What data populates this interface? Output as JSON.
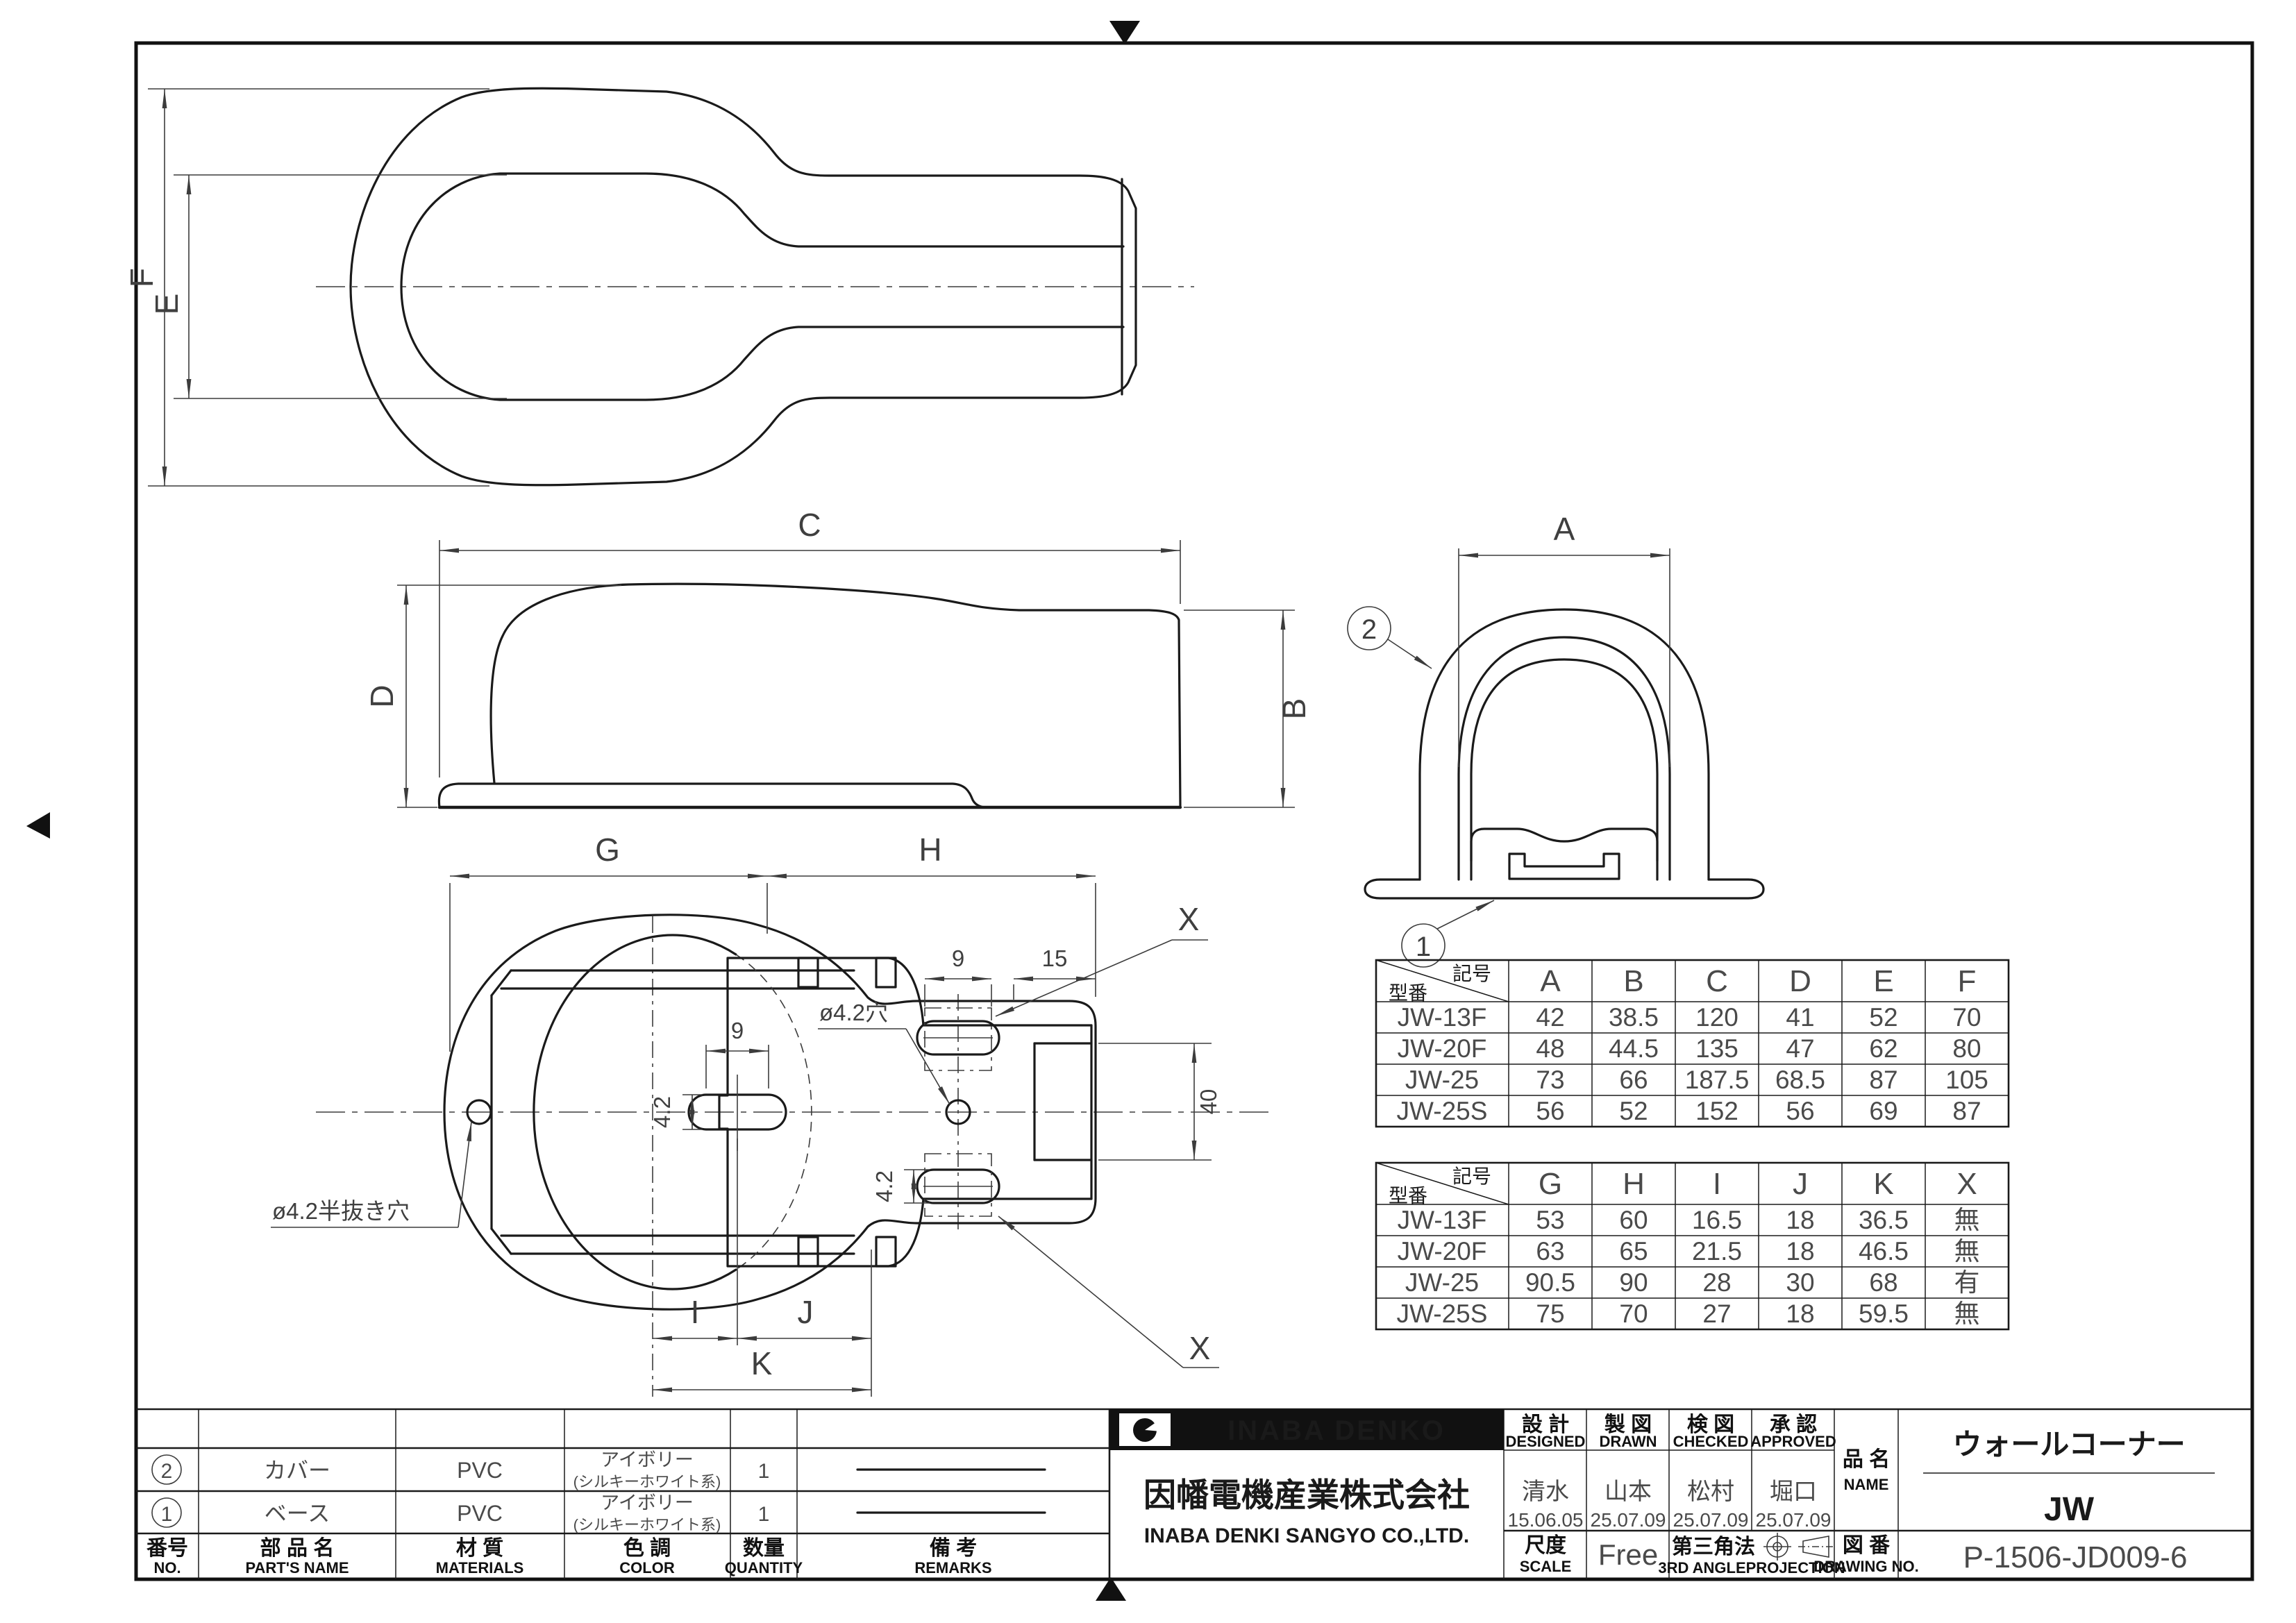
{
  "sheet": {
    "background": "#ffffff",
    "line_color": "#1a1a1a",
    "dim_color": "#4a4a4a"
  },
  "views": {
    "top_view": {
      "dim_E": "E",
      "dim_F": "F"
    },
    "side_view": {
      "dim_B": "B",
      "dim_C": "C",
      "dim_D": "D"
    },
    "front_view": {
      "dim_A": "A",
      "balloon_cover": "2",
      "balloon_base": "1"
    },
    "bottom_view": {
      "dim_G": "G",
      "dim_H": "H",
      "dim_I": "I",
      "dim_J": "J",
      "dim_K": "K",
      "dim_X_top": "X",
      "dim_X_bottom": "X",
      "dim_9_slot": "9",
      "dim_9_x": "9",
      "dim_15": "15",
      "dim_40": "40",
      "dim_42_a": "4.2",
      "dim_42_b": "4.2",
      "note_hole": "ø4.2穴",
      "note_half_hole": "ø4.2半抜き穴"
    }
  },
  "dim_table_1": {
    "corner_top": "記号",
    "corner_bottom": "型番",
    "columns": [
      "A",
      "B",
      "C",
      "D",
      "E",
      "F"
    ],
    "rows": [
      [
        "JW-13F",
        "42",
        "38.5",
        "120",
        "41",
        "52",
        "70"
      ],
      [
        "JW-20F",
        "48",
        "44.5",
        "135",
        "47",
        "62",
        "80"
      ],
      [
        "JW-25",
        "73",
        "66",
        "187.5",
        "68.5",
        "87",
        "105"
      ],
      [
        "JW-25S",
        "56",
        "52",
        "152",
        "56",
        "69",
        "87"
      ]
    ]
  },
  "dim_table_2": {
    "corner_top": "記号",
    "corner_bottom": "型番",
    "columns": [
      "G",
      "H",
      "I",
      "J",
      "K",
      "X"
    ],
    "rows": [
      [
        "JW-13F",
        "53",
        "60",
        "16.5",
        "18",
        "36.5",
        "無"
      ],
      [
        "JW-20F",
        "63",
        "65",
        "21.5",
        "18",
        "46.5",
        "無"
      ],
      [
        "JW-25",
        "90.5",
        "90",
        "28",
        "30",
        "68",
        "有"
      ],
      [
        "JW-25S",
        "75",
        "70",
        "27",
        "18",
        "59.5",
        "無"
      ]
    ]
  },
  "parts_table": {
    "headers": {
      "no_jp": "番号",
      "no_en": "NO.",
      "name_jp": "部 品 名",
      "name_en": "PART'S NAME",
      "material_jp": "材 質",
      "material_en": "MATERIALS",
      "color_jp": "色 調",
      "color_en": "COLOR",
      "qty_jp": "数量",
      "qty_en": "QUANTITY",
      "remarks_jp": "備  考",
      "remarks_en": "REMARKS"
    },
    "rows": [
      {
        "no": "2",
        "name": "カバー",
        "material": "PVC",
        "color_main": "アイボリー",
        "color_sub": "(シルキーホワイト系)",
        "qty": "1"
      },
      {
        "no": "1",
        "name": "ベース",
        "material": "PVC",
        "color_main": "アイボリー",
        "color_sub": "(シルキーホワイト系)",
        "qty": "1"
      }
    ]
  },
  "title_block": {
    "brand": "INABA DENKO",
    "company_jp": "因幡電機産業株式会社",
    "company_en": "INABA DENKI SANGYO CO.,LTD.",
    "designed": {
      "label_jp": "設 計",
      "label_en": "DESIGNED",
      "person": "清水",
      "date": "15.06.05"
    },
    "drawn": {
      "label_jp": "製 図",
      "label_en": "DRAWN",
      "person": "山本",
      "date": "25.07.09"
    },
    "checked": {
      "label_jp": "検 図",
      "label_en": "CHECKED",
      "person": "松村",
      "date": "25.07.09"
    },
    "approved": {
      "label_jp": "承 認",
      "label_en": "APPROVED",
      "person": "堀口",
      "date": "25.07.09"
    },
    "scale": {
      "label_jp": "尺度",
      "label_en": "SCALE",
      "value": "Free"
    },
    "projection": {
      "label_jp": "第三角法",
      "label_en": "3RD ANGLEPROJECTION"
    },
    "name": {
      "label_jp": "品 名",
      "label_en": "NAME",
      "product": "ウォールコーナー",
      "code": "JW"
    },
    "drawing_no": {
      "label_jp": "図 番",
      "label_en": "DRAWING NO.",
      "value": "P-1506-JD009-6"
    }
  }
}
